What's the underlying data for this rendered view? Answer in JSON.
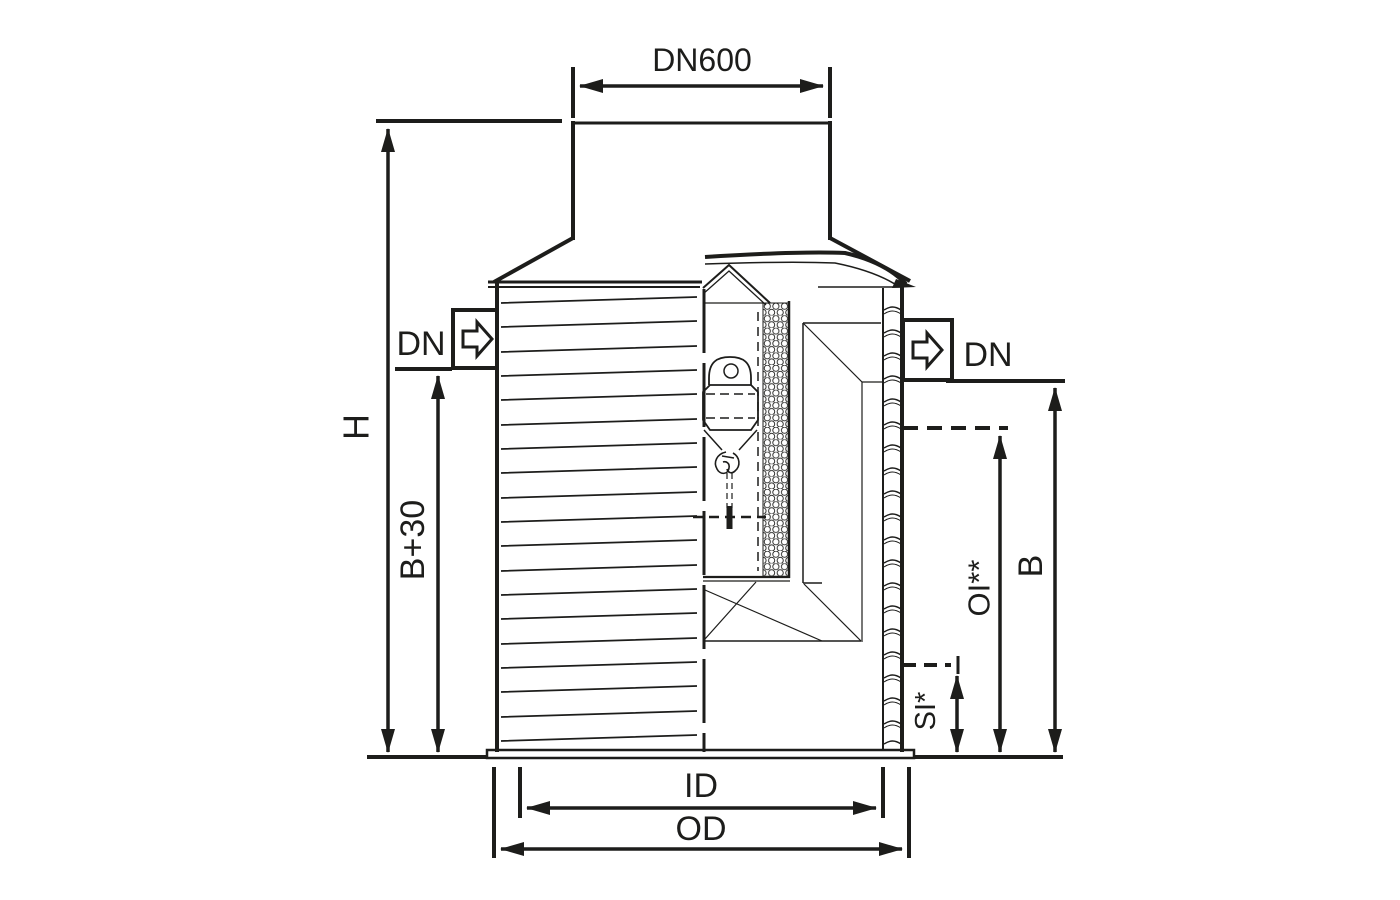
{
  "drawing": {
    "type": "separator-tank-cross-section",
    "background": "#ffffff",
    "line_color": "#1d1d1b",
    "labels": {
      "dn600": "DN600",
      "dn_inlet": "DN",
      "dn_outlet": "DN",
      "h": "H",
      "b30": "B+30",
      "oi": "OI**",
      "b": "B",
      "si": "SI*",
      "id": "ID",
      "od": "OD"
    },
    "icons": {
      "inlet": "flow-direction-arrow",
      "outlet": "flow-direction-arrow"
    }
  }
}
